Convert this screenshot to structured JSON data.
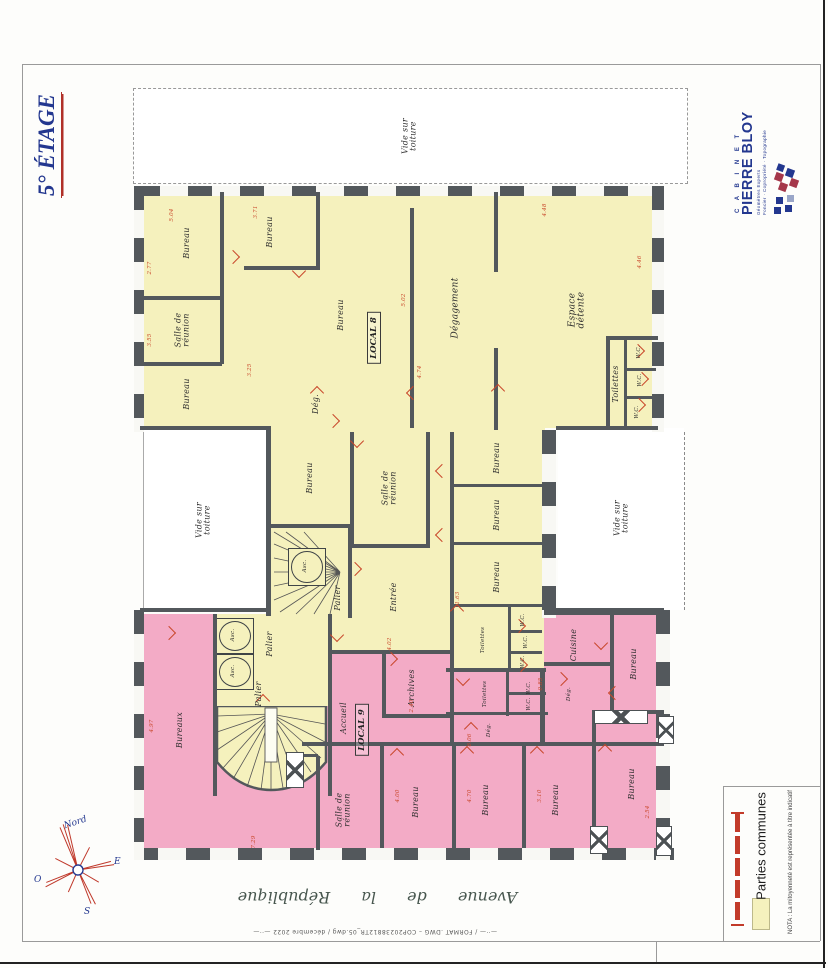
{
  "sheet": {
    "title": "5° ÉTAGE",
    "street": "Avenue de la République",
    "footer_note": "—··—  / FORMAT .DWG  –  COP20238812TR_05.dwg  /  décembre 2022  —··—"
  },
  "logo": {
    "cabinet": "C A B I N E T",
    "name": "PIERRE BLOY",
    "tagline1": "Géomètres Experts",
    "tagline2": "Foncier · Copropriété · Topographie"
  },
  "compass": {
    "north": "Nord",
    "east": "E",
    "west": "O",
    "south": "S"
  },
  "legend": {
    "swatch_color": "#f5f1bd",
    "label": "Parties communes",
    "nota": "NOTA : La mitoyenneté est représentée à titre indicatif"
  },
  "plan": {
    "locals": [
      "LOCAL 8",
      "LOCAL 9"
    ],
    "labels": [
      "Bureau",
      "Bureau",
      "Salle de\nréunion",
      "Bureau",
      "Dég.",
      "Bureau",
      "Dégagement",
      "Espace\ndétente",
      "Toilettes",
      "W.C.",
      "W.C.",
      "W.C.",
      "Vide sur\ntoiture",
      "Vide sur\ntoiture",
      "Vide sur\ntoiture",
      "Bureau",
      "Salle de\nréunion",
      "Entrée",
      "Asc.",
      "Palier",
      "Bureau",
      "Bureau",
      "Bureau",
      "Toilettes",
      "W.C.",
      "W.C.",
      "W.C.",
      "Asc.",
      "Asc.",
      "Palier",
      "Palier",
      "Bureaux",
      "Accueil",
      "Archives",
      "Toilettes",
      "W.C.",
      "W.C.",
      "Dég.",
      "Cuisine",
      "Dég.",
      "Bureau",
      "Bureau",
      "Salle de\nréunion",
      "Bureau",
      "Bureau",
      "Bureau"
    ],
    "dims": [
      "5.04",
      "3.71",
      "4.48",
      "4.46",
      "2.77",
      "3.55",
      "5.02",
      "4.74",
      "3.25",
      "2.40",
      "4.02",
      "1.63",
      "0.85",
      "6.06",
      "4.00",
      "4.70",
      "3.10",
      "2.54",
      "7.29",
      "4.97"
    ]
  }
}
